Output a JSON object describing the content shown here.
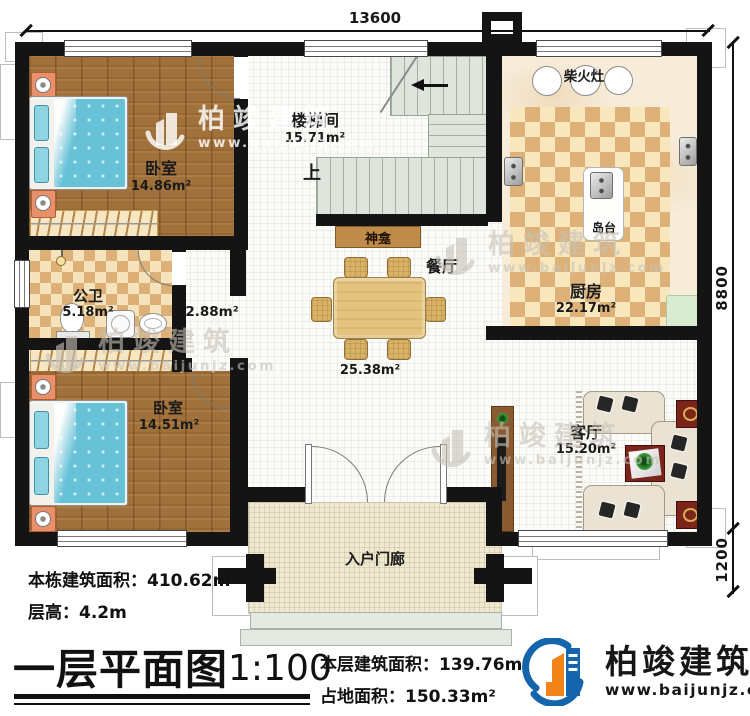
{
  "dimensions": {
    "width_top": "13600",
    "height_main": "8800",
    "porch_depth": "1200"
  },
  "rooms": {
    "bedroom_top": {
      "name": "卧室",
      "area": "14.86m²"
    },
    "stair_hall": {
      "name": "楼梯间",
      "area": "15.71m²",
      "up": "上"
    },
    "kitchen": {
      "name": "厨房",
      "area": "22.17m²"
    },
    "wood_stove": "柴火灶",
    "island": "岛台",
    "shrine": "神龛",
    "dining": {
      "name": "餐厅",
      "area": "25.38m²"
    },
    "bathroom": {
      "name": "公卫",
      "area": "5.18m²"
    },
    "hallway_area": "2.88m²",
    "bedroom_bottom": {
      "name": "卧室",
      "area": "14.51m²"
    },
    "living": {
      "name": "客厅",
      "area": "15.20m²"
    },
    "porch": "入户门廊"
  },
  "footer": {
    "building_area_label": "本栋建筑面积：",
    "building_area_value": "410.62m²",
    "floor_height_label": "层高：",
    "floor_height_value": "4.2m",
    "title": "一层平面图",
    "scale": "1:100",
    "floor_area_label": "本层建筑面积：",
    "floor_area_value": "139.76m²",
    "footprint_label": "占地面积：",
    "footprint_value": "150.33m²"
  },
  "brand": {
    "name": "柏竣建筑",
    "site": "www.baijunjz.com"
  },
  "colors": {
    "wall": "#141414",
    "wood_floor": "#a0713a",
    "bed_blue": "#67c2d8",
    "checker_tan": "#dcb077",
    "brand_blue": "#1565ad",
    "brand_orange": "#f08418"
  }
}
